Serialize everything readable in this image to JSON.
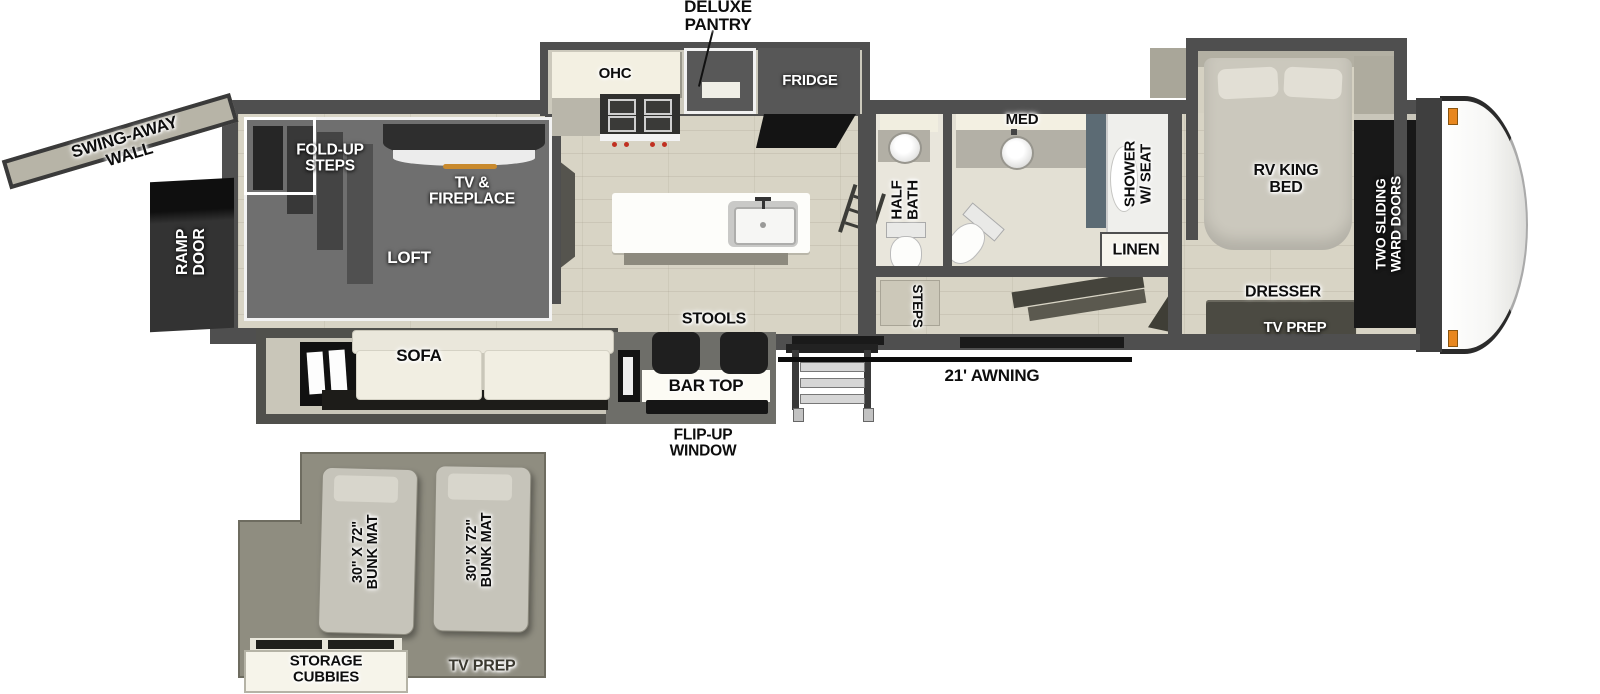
{
  "labels": {
    "deluxe_pantry": "DELUXE\nPANTRY",
    "ohc": "OHC",
    "fridge": "FRIDGE",
    "med": "MED",
    "swing_away_wall": "SWING-AWAY\nWALL",
    "ramp_door": "RAMP\nDOOR",
    "fold_up_steps": "FOLD-UP\nSTEPS",
    "tv_fireplace": "TV &\nFIREPLACE",
    "loft": "LOFT",
    "sofa": "SOFA",
    "stools": "STOOLS",
    "bar_top": "BAR TOP",
    "flip_up_window": "FLIP-UP\nWINDOW",
    "half_bath": "HALF\nBATH",
    "steps": "STEPS",
    "shower_w_seat": "SHOWER\nW/ SEAT",
    "linen": "LINEN",
    "rv_king_bed": "RV KING\nBED",
    "two_sliding_ward_doors": "TWO SLIDING\nWARD DOORS",
    "dresser": "DRESSER",
    "tv_prep_bedroom": "TV PREP",
    "awning": "21' AWNING",
    "bunk_mat_left": "30\" X 72\"\nBUNK MAT",
    "bunk_mat_right": "30\" X 72\"\nBUNK MAT",
    "storage_cubbies": "STORAGE\nCUBBIES",
    "tv_prep_loft": "TV PREP"
  },
  "colors": {
    "wall": "#4f4f4f",
    "floor": "#d8d4c5",
    "loft_overlay": "#6f6f6f",
    "accent_amber": "#c98a2e",
    "marker_light": "#e8871f"
  }
}
